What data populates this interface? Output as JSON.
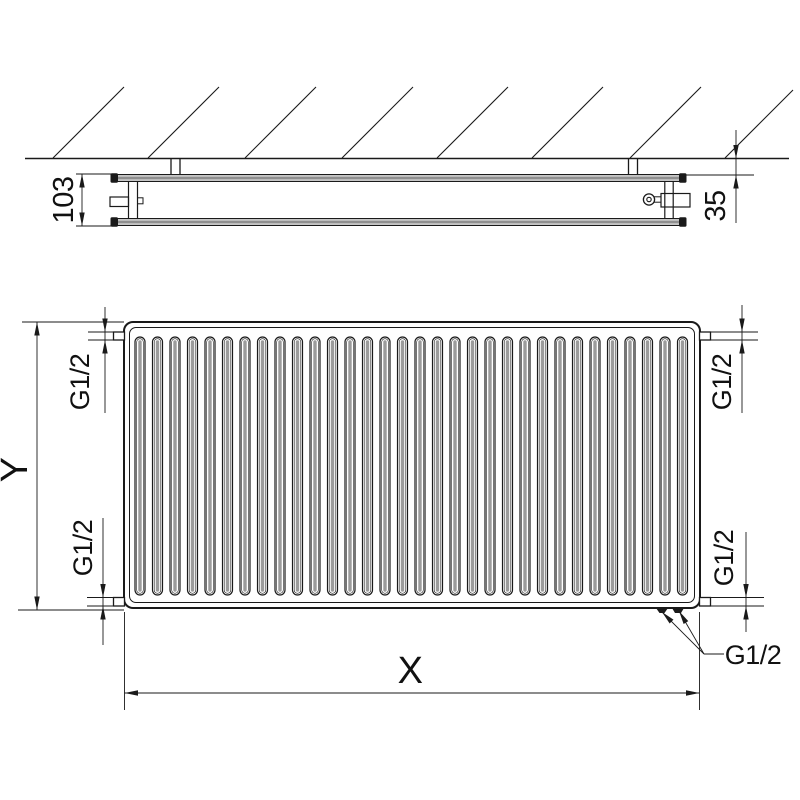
{
  "page": {
    "background": "#ffffff",
    "line_color": "#1a1a1a",
    "panel_fill": "#8f8f8f",
    "fin_core_color": "#9b9b9b"
  },
  "side_view": {
    "depth_dimension": "103",
    "wall_distance_dimension": "35"
  },
  "front_view": {
    "height_dimension": "Y",
    "width_dimension": "X",
    "fin_count": 32,
    "connections": {
      "top_left": "G1/2",
      "top_right": "G1/2",
      "bottom_left": "G1/2",
      "bottom_right": "G1/2",
      "bottom_center_leader": "G1/2"
    }
  }
}
